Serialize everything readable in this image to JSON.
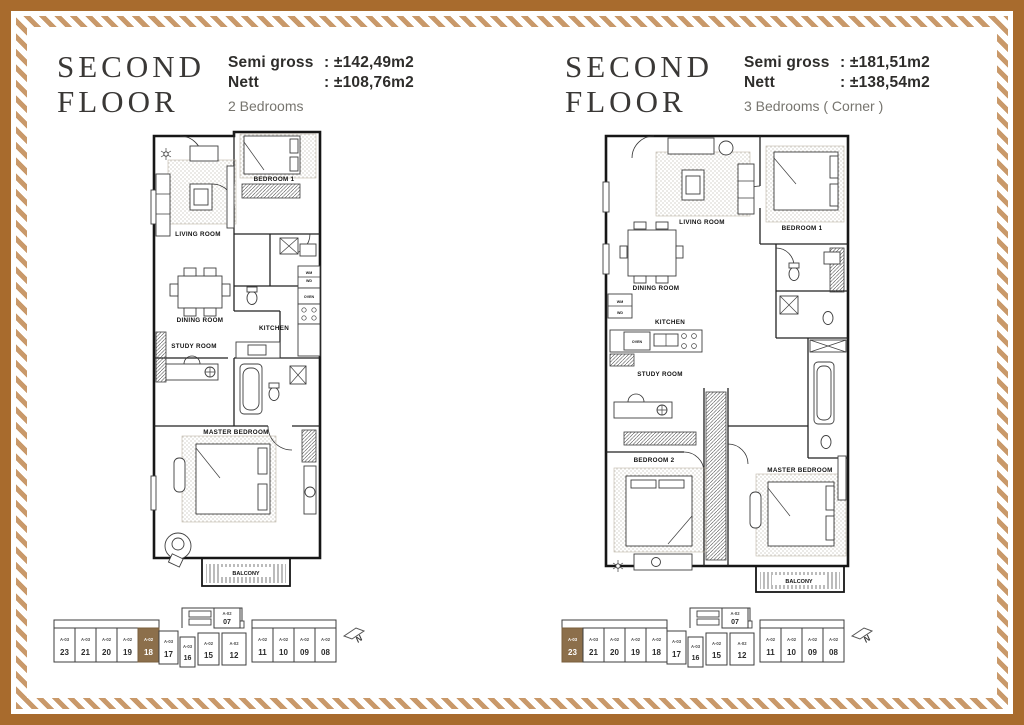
{
  "page": {
    "outer_border_color": "#a86b2d",
    "stripe_color": "#c9996a",
    "highlight_color": "#8c6f4b"
  },
  "keyplan_north": "N",
  "keyplan_units": [
    {
      "code": "A-03",
      "num": "23"
    },
    {
      "code": "A-03",
      "num": "21"
    },
    {
      "code": "A-02",
      "num": "20"
    },
    {
      "code": "A-02",
      "num": "19"
    },
    {
      "code": "A-02",
      "num": "18"
    },
    {
      "code": "A-03",
      "num": "17"
    },
    {
      "code": "A-03",
      "num": "16"
    },
    {
      "code": "A-02",
      "num": "15"
    },
    {
      "code": "A-02",
      "num": "12"
    },
    {
      "code": "A-02",
      "num": "07"
    },
    {
      "code": "A-02",
      "num": "11"
    },
    {
      "code": "A-02",
      "num": "10"
    },
    {
      "code": "A-02",
      "num": "09"
    },
    {
      "code": "A-02",
      "num": "08"
    }
  ],
  "panels": [
    {
      "title_line1": "SECOND",
      "title_line2": "FLOOR",
      "specs": {
        "semi_gross_label": "Semi gross",
        "semi_gross_value": ": ±142,49m2",
        "nett_label": "Nett",
        "nett_value": ": ±108,76m2",
        "bedrooms": "2 Bedrooms"
      },
      "rooms": {
        "living": "LIVING ROOM",
        "bedroom1": "BEDROOM 1",
        "dining": "DINING ROOM",
        "kitchen": "KITCHEN",
        "study": "STUDY ROOM",
        "master": "MASTER BEDROOM",
        "balcony": "BALCONY",
        "wm": "WM",
        "wd": "WD",
        "oven": "OVEN"
      },
      "keyplan": {
        "highlighted_unit": "18"
      }
    },
    {
      "title_line1": "SECOND",
      "title_line2": "FLOOR",
      "specs": {
        "semi_gross_label": "Semi gross",
        "semi_gross_value": ": ±181,51m2",
        "nett_label": "Nett",
        "nett_value": ": ±138,54m2",
        "bedrooms": "3 Bedrooms ( Corner )"
      },
      "rooms": {
        "living": "LIVING ROOM",
        "bedroom1": "BEDROOM 1",
        "bedroom2": "BEDROOM 2",
        "dining": "DINING ROOM",
        "kitchen": "KITCHEN",
        "study": "STUDY ROOM",
        "master": "MASTER BEDROOM",
        "balcony": "BALCONY",
        "wm": "WM",
        "wd": "WD",
        "oven": "OVEN"
      },
      "keyplan": {
        "highlighted_unit": "23"
      }
    }
  ]
}
